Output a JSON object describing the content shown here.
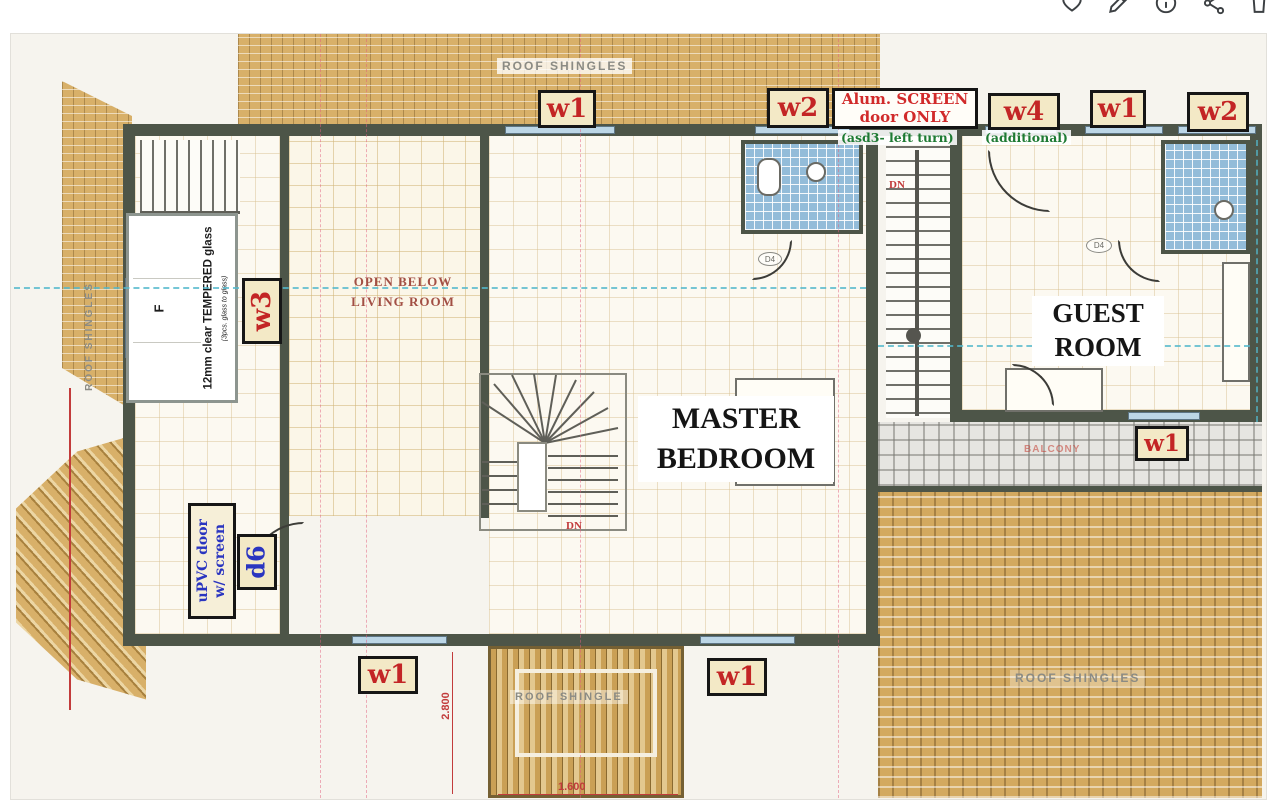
{
  "toolbar": {
    "icons": [
      {
        "name": "favorite"
      },
      {
        "name": "edit"
      },
      {
        "name": "info"
      },
      {
        "name": "share"
      },
      {
        "name": "delete"
      }
    ]
  },
  "colors": {
    "tag_red": "#c32525",
    "note_green": "#1e7a33",
    "door_blue": "#2a35c0",
    "shingle_tan": "#d8b069",
    "tile_blue": "#93bcd9",
    "wall": "#4d5548",
    "dim_red": "#c23b3b",
    "centerline_cyan": "#52b8cc"
  },
  "plan": {
    "window_tags": {
      "top_w1": "w1",
      "top_w2": "w2",
      "top_w4": "w4",
      "topright_w1": "w1",
      "topright_w2": "w2",
      "left_w3": "w3",
      "left_d6": "d6",
      "bottom_w1a": "w1",
      "bottom_w1b": "w1",
      "deck_w1": "w1"
    },
    "notes": {
      "alum_line1": "Alum. SCREEN",
      "alum_line2": "door ONLY",
      "asd3": "(asd3- left turn)",
      "additional": "(additional)",
      "upvc_line1": "uPVC door",
      "upvc_line2": "w/ screen",
      "glass_f": "F",
      "glass_main": "12mm clear TEMPERED glass",
      "glass_sub": "(3pcs. glass to glass)"
    },
    "rooms": {
      "open_below_line1": "OPEN BELOW",
      "open_below_line2": "LIVING ROOM",
      "master_line1": "MASTER",
      "master_line2": "BEDROOM",
      "guest_line1": "GUEST",
      "guest_line2": "ROOM"
    },
    "annotations": {
      "roof_top": "ROOF SHINGLES",
      "roof_left": "ROOF SHINGLES",
      "roof_dormer": "ROOF SHINGLE",
      "roof_right": "ROOF SHINGLES",
      "dn_main": "DN",
      "dn_right": "DN",
      "balcony": "BALCONY",
      "door_d4_a": "D4",
      "door_d4_b": "D4"
    },
    "dimensions": {
      "vertical": "2.800",
      "horizontal": "1.600"
    }
  }
}
